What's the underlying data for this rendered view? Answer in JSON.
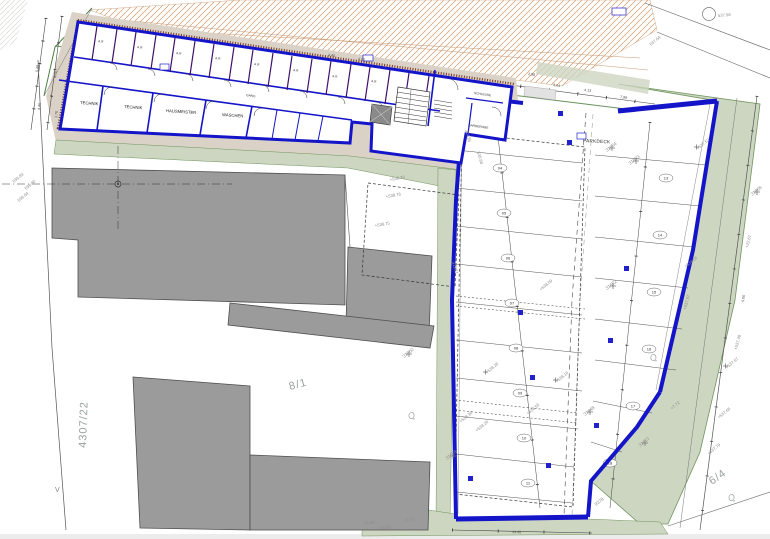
{
  "plan": {
    "rooms": {
      "ar": "A.R",
      "technik_1": "TECHNIK",
      "technik_2": "TECHNIK",
      "hausmeister": "HAUSMEISTER",
      "waschen": "WASCHEN",
      "gang": "GANG",
      "schleuse": "SCHLEUSE",
      "garderobe": "GARDEROBE",
      "parkdeck": "PARKDECK"
    },
    "parcels": {
      "p4307_22": "4307/22",
      "p8_1": "8/1",
      "p6_4": "6/4",
      "q": "Q",
      "v": "V"
    },
    "survey_points": [
      "31654",
      "31653",
      "31652",
      "31648",
      "31657",
      "31658",
      "31660",
      "31661",
      "31668",
      "30435",
      "9378"
    ],
    "elevations": [
      "539.83",
      "539.80",
      "539.84",
      "+538.20",
      "+538.76",
      "+538.75",
      "+538.28",
      "+538.26",
      "+538.16",
      "+538.36",
      "+538.58",
      "+538.09",
      "+538.05",
      "+537.67",
      "+537.68",
      "+537.79",
      "+537.52",
      "+537.97",
      "+537.48",
      "537.58",
      "537.64",
      "+0.08",
      "539.62",
      "+5.73",
      "+7.72",
      "+22.67",
      "538.68"
    ],
    "dimensions": [
      "5.48",
      "4.46",
      "8.70",
      "1.70",
      "4.40",
      "4.00",
      "3.64",
      "4.13",
      "5.00",
      "2.98",
      "13.45",
      "7.98"
    ],
    "parking_spots_left": [
      "04",
      "05",
      "06",
      "07",
      "08",
      "09",
      "10",
      "11"
    ],
    "parking_spots_right": [
      "13",
      "14",
      "15",
      "16",
      "17",
      "18"
    ],
    "colors": {
      "wall_blue": "#1414c8",
      "partition_purple": "#41106e",
      "existing_gray": "#9b9b9b",
      "green_area": "#cdd6c1",
      "earth_tan": "#dad2c6",
      "hatch_orange": "#d49a6e"
    }
  }
}
